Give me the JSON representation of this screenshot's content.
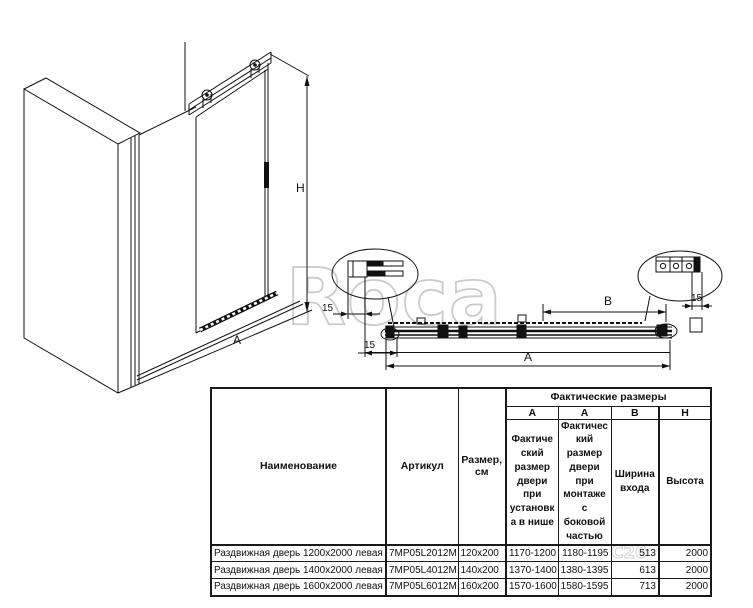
{
  "watermark": {
    "brand": "Roca",
    "fragment": "C20"
  },
  "diagram": {
    "iso": {
      "height_label": "H",
      "width_label": "A"
    },
    "plan": {
      "a_label": "A",
      "b_label": "B",
      "offset_top": "15",
      "offset_bottom": "15",
      "offset_right": "15"
    }
  },
  "table": {
    "columns": {
      "name": "Наименование",
      "article": "Артикул",
      "size": "Размер, см",
      "actual_group": "Фактические размеры",
      "sub": [
        "А",
        "А",
        "В",
        "Н"
      ],
      "desc_niche": "Фактический размер двери при установка в нише",
      "desc_side": "Фактический размер двери при монтаже с боковой частью",
      "entry_width": "Ширина входа",
      "col_height": "Высота"
    },
    "rows": [
      {
        "name": "Раздвижная дверь 1200х2000 левая",
        "article": "7MP05L2012M",
        "size": "120x200",
        "a_niche": "1170-1200",
        "a_side": "1180-1195",
        "b": "513",
        "h": "2000"
      },
      {
        "name": "Раздвижная дверь 1400х2000 левая",
        "article": "7MP05L4012M",
        "size": "140x200",
        "a_niche": "1370-1400",
        "a_side": "1380-1395",
        "b": "613",
        "h": "2000"
      },
      {
        "name": "Раздвижная дверь 1600х2000 левая",
        "article": "7MP05L6012M",
        "size": "160x200",
        "a_niche": "1570-1600",
        "a_side": "1580-1595",
        "b": "713",
        "h": "2000"
      }
    ]
  }
}
